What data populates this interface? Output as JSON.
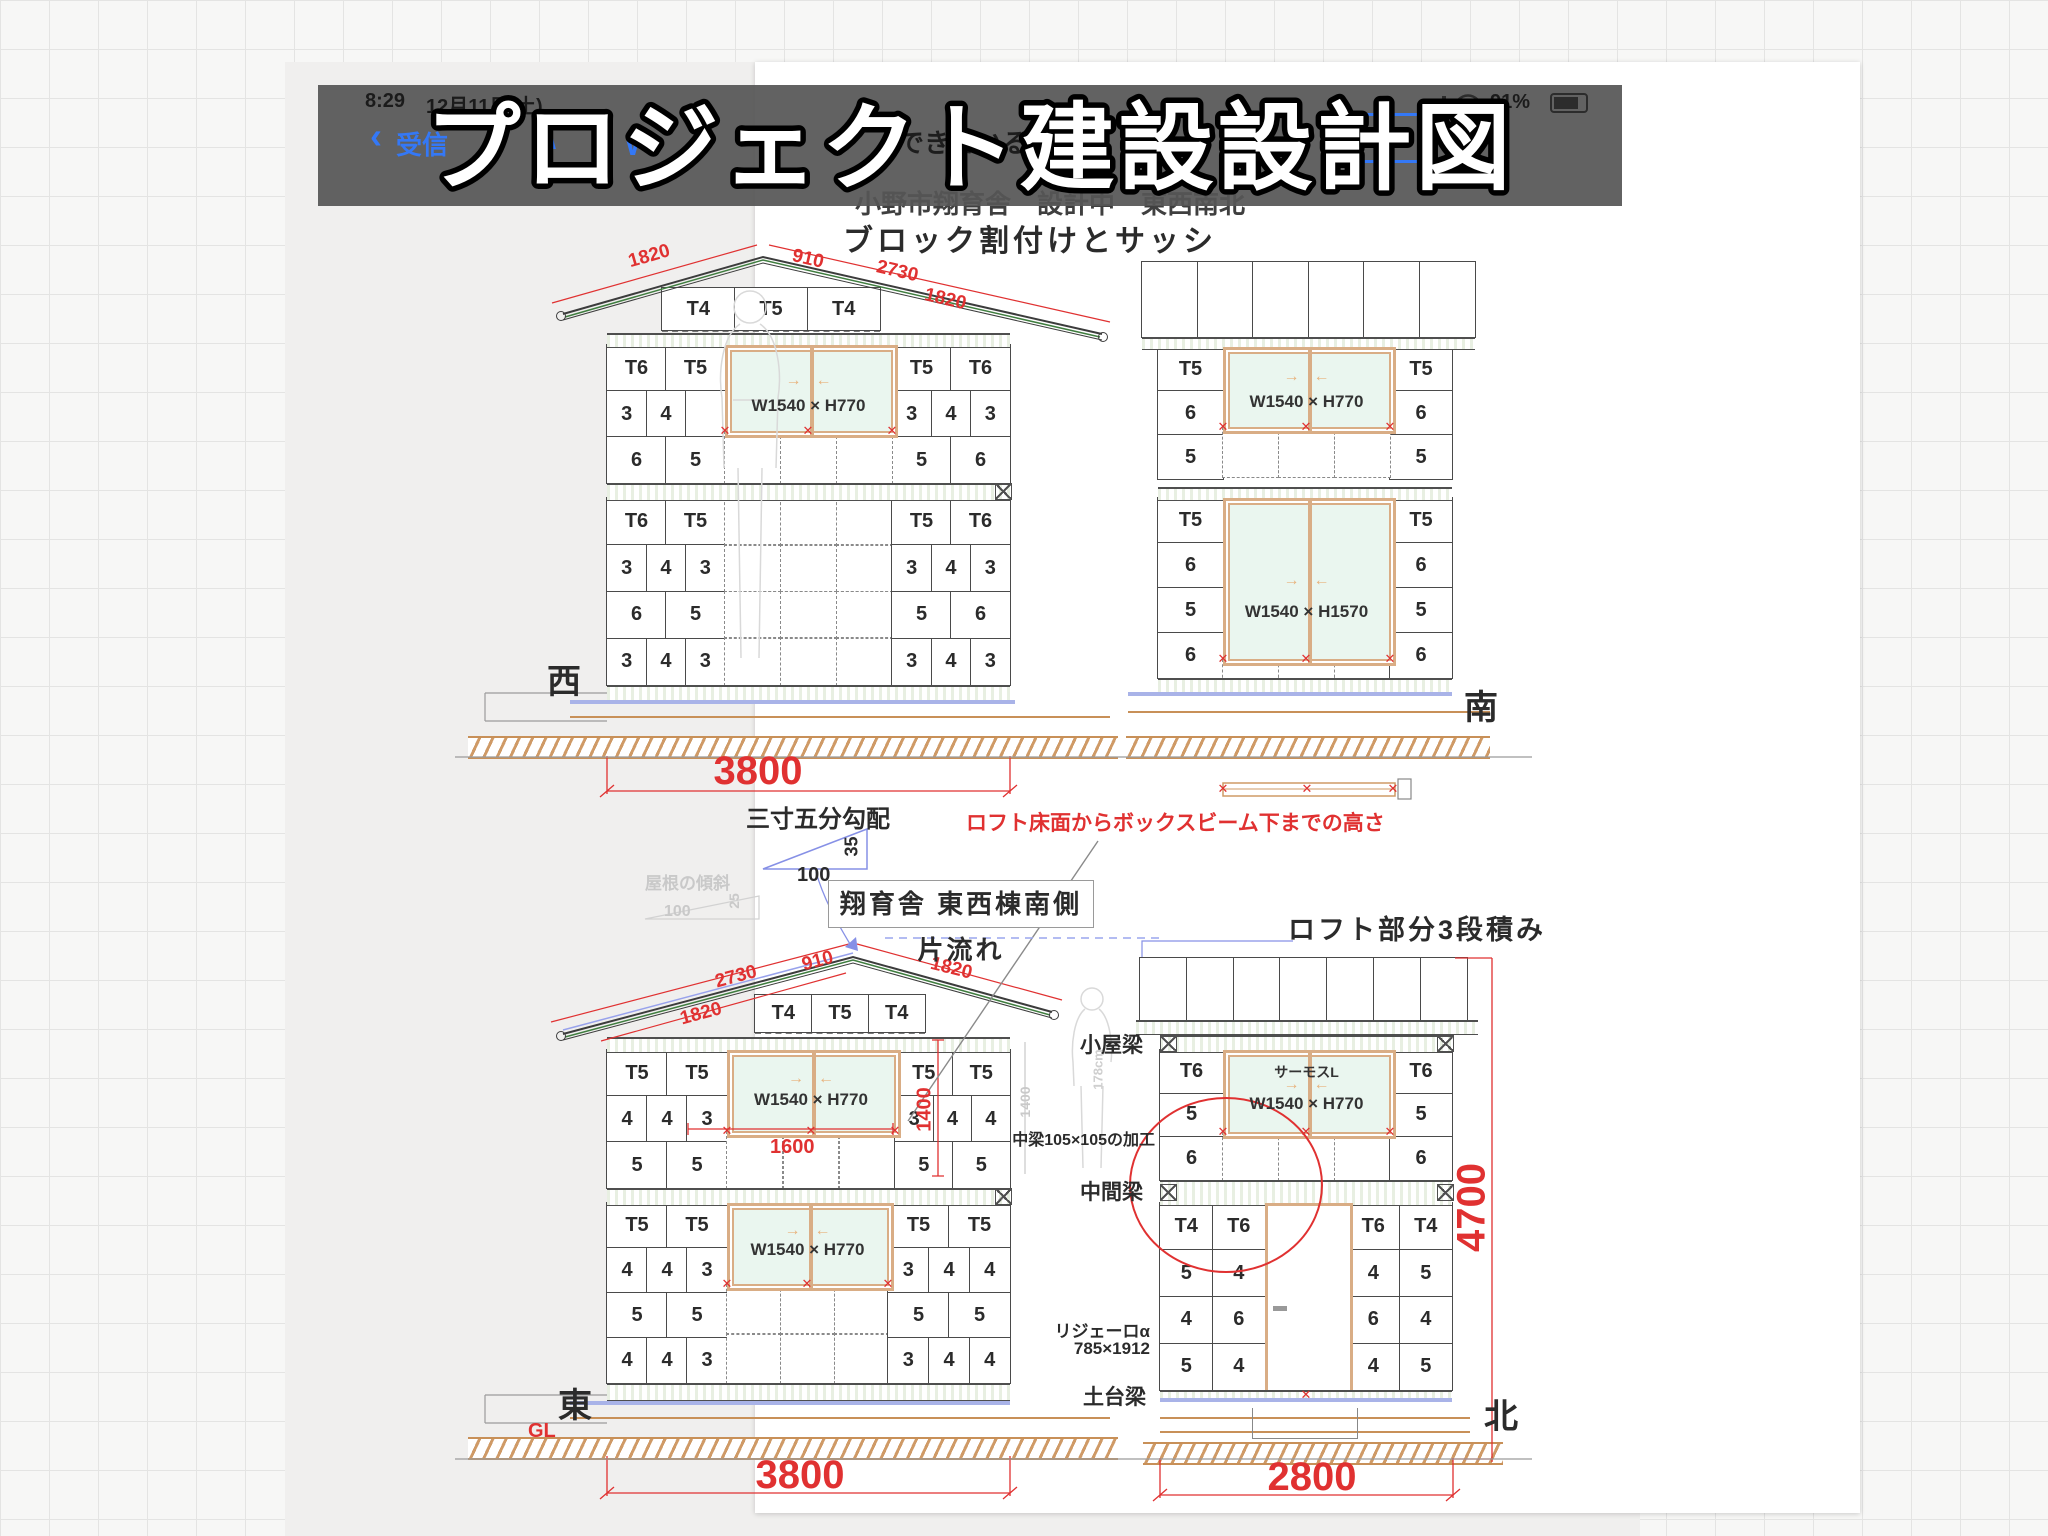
{
  "status_bar": {
    "time": "8:29",
    "date": "12月11日(土)",
    "battery_pct": "91%"
  },
  "mail_bar": {
    "back_chevron": "‹",
    "inbox": "受信",
    "prev": "∧",
    "next": "∨",
    "subject_fragment": "できている"
  },
  "sticker_title": "プロジェクト建設設計図",
  "sheet": {
    "header": "小野市翔育舎　設計中　東西南北",
    "title": "ブロック割付けとサッシ"
  },
  "symbols": {
    "x": "✕",
    "left": "←",
    "right": "→"
  },
  "west": {
    "label": "西",
    "base_dim": "3800",
    "roof": {
      "d1": "1820",
      "d2": "910",
      "d3": "2730",
      "d4": "1820"
    },
    "gable": [
      [
        "T4",
        "T5",
        "T4"
      ]
    ],
    "upper_left": [
      [
        "T6",
        "T5"
      ],
      [
        "3",
        "4",
        ""
      ],
      [
        "6",
        "5"
      ]
    ],
    "upper_right": [
      [
        "T5",
        "T6"
      ],
      [
        "3",
        "4",
        "3"
      ],
      [
        "5",
        "6"
      ]
    ],
    "lower_left": [
      [
        "T6",
        "T5"
      ],
      [
        "3",
        "4",
        "3"
      ],
      [
        "6",
        "5"
      ],
      [
        "3",
        "4",
        "3"
      ]
    ],
    "lower_right": [
      [
        "T5",
        "T6"
      ],
      [
        "3",
        "4",
        "3"
      ],
      [
        "5",
        "6"
      ],
      [
        "3",
        "4",
        "3"
      ]
    ],
    "window1": "W1540 × H770"
  },
  "south": {
    "label": "南",
    "upper_left": [
      [
        "T5"
      ],
      [
        "6"
      ],
      [
        "5"
      ]
    ],
    "upper_right": [
      [
        "T5"
      ],
      [
        "6"
      ],
      [
        "5"
      ]
    ],
    "lower_left": [
      [
        "T5"
      ],
      [
        "6"
      ],
      [
        "5"
      ],
      [
        "6"
      ]
    ],
    "lower_right": [
      [
        "T5"
      ],
      [
        "6"
      ],
      [
        "5"
      ],
      [
        "6"
      ]
    ],
    "window1": "W1540 × H770",
    "window2": "W1540 × H1570"
  },
  "east": {
    "label": "東",
    "gl": "GL",
    "base_dim": "3800",
    "roof": {
      "d1": "2730",
      "d2": "1820",
      "d3": "910",
      "d4": "1820"
    },
    "gable": [
      [
        "T4",
        "T5",
        "T4"
      ]
    ],
    "upper_left": [
      [
        "T5",
        "T5"
      ],
      [
        "4",
        "4",
        "3"
      ],
      [
        "5",
        "5"
      ]
    ],
    "upper_right": [
      [
        "T5",
        "T5"
      ],
      [
        "3",
        "4",
        "4"
      ],
      [
        "5",
        "5"
      ]
    ],
    "lower_left": [
      [
        "T5",
        "T5"
      ],
      [
        "4",
        "4",
        "3"
      ],
      [
        "5",
        "5"
      ],
      [
        "4",
        "4",
        "3"
      ]
    ],
    "lower_right": [
      [
        "T5",
        "T5"
      ],
      [
        "3",
        "4",
        "4"
      ],
      [
        "5",
        "5"
      ],
      [
        "3",
        "4",
        "4"
      ]
    ],
    "window1": "W1540 × H770",
    "window2": "W1540 × H770",
    "dim_1600": "1600",
    "dim_1400": "1400"
  },
  "north": {
    "label": "北",
    "title": "ロフト部分3段積み",
    "height_dim": "4700",
    "base_dim": "2800",
    "upper_left": [
      [
        "T6"
      ],
      [
        "5"
      ],
      [
        "6"
      ]
    ],
    "upper_right": [
      [
        "T6"
      ],
      [
        "5"
      ],
      [
        "6"
      ]
    ],
    "lower_left": [
      [
        "T4",
        "T6"
      ],
      [
        "5",
        "4"
      ],
      [
        "4",
        "6"
      ],
      [
        "5",
        "4"
      ]
    ],
    "lower_right": [
      [
        "T6",
        "T4"
      ],
      [
        "4",
        "5"
      ],
      [
        "6",
        "4"
      ],
      [
        "4",
        "5"
      ]
    ],
    "window_brand": "サーモスL",
    "window1": "W1540 × H770",
    "beam_top": "小屋梁",
    "beam_mid": "中間梁",
    "beam_base": "土台梁",
    "beam_note": "中梁105×105の加工",
    "door_model": "リジェーロα",
    "door_size": "785×1912",
    "figure_height": "178cm",
    "dim_1400": "1400"
  },
  "notes": {
    "slope_label": "三寸五分勾配",
    "slope_rise": "35",
    "slope_run": "100",
    "roof_slope_label": "屋根の傾斜",
    "roof_slope_rise": "25",
    "roof_slope_run": "100",
    "drawing_caption": "翔育舎 東西棟南側片流れ",
    "loft_note": "ロフト床面からボックスビーム下までの高さ"
  }
}
